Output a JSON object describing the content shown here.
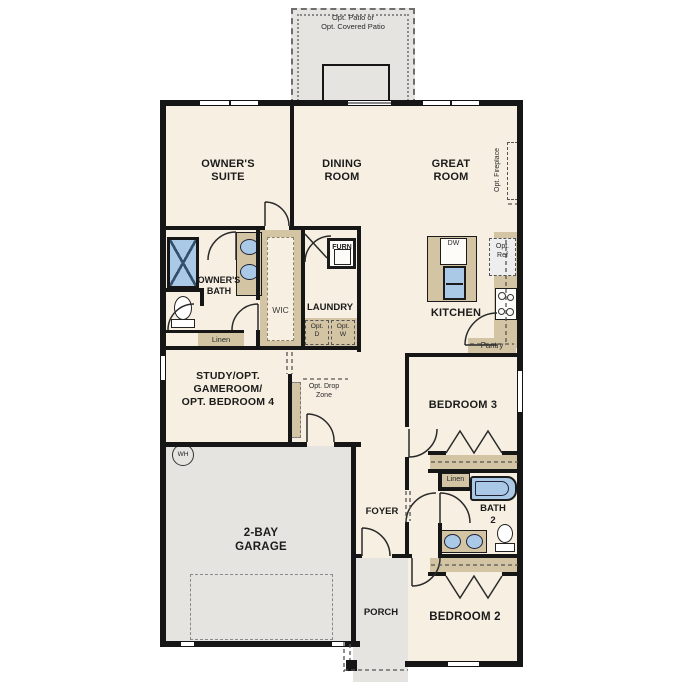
{
  "plan_labels": {
    "patio": "Opt. Patio or\nOpt. Covered Patio",
    "owners_suite": "OWNER'S\nSUITE",
    "dining_room": "DINING\nROOM",
    "great_room": "GREAT\nROOM",
    "opt_fireplace": "Opt. Fireplace",
    "owners_bath": "OWNER'S\nBATH",
    "wic": "WIC",
    "linen_owners": "Linen",
    "laundry": "LAUNDRY",
    "furnace": "FURN",
    "opt_dryer": "Opt.\nD",
    "opt_washer": "Opt.\nW",
    "kitchen": "KITCHEN",
    "dishwasher": "DW",
    "opt_fridge": "Opt.\nRef",
    "pantry": "Pantry",
    "study": "STUDY/OPT.\nGAMEROOM/\nOPT. BEDROOM 4",
    "opt_drop_zone": "Opt. Drop\nZone",
    "water_heater": "WH",
    "garage": "2-BAY\nGARAGE",
    "foyer": "FOYER",
    "bedroom3": "BEDROOM 3",
    "linen_hall": "Linen",
    "bath2": "BATH\n2",
    "bedroom2": "BEDROOM 2",
    "porch": "PORCH"
  },
  "colors": {
    "wall": "#161616",
    "floor": "#f7f0e2",
    "exterior_concrete": "#e5e4e1",
    "casework_tan": "#d3c4a4",
    "fixture_blue": "#a9c9e6"
  }
}
